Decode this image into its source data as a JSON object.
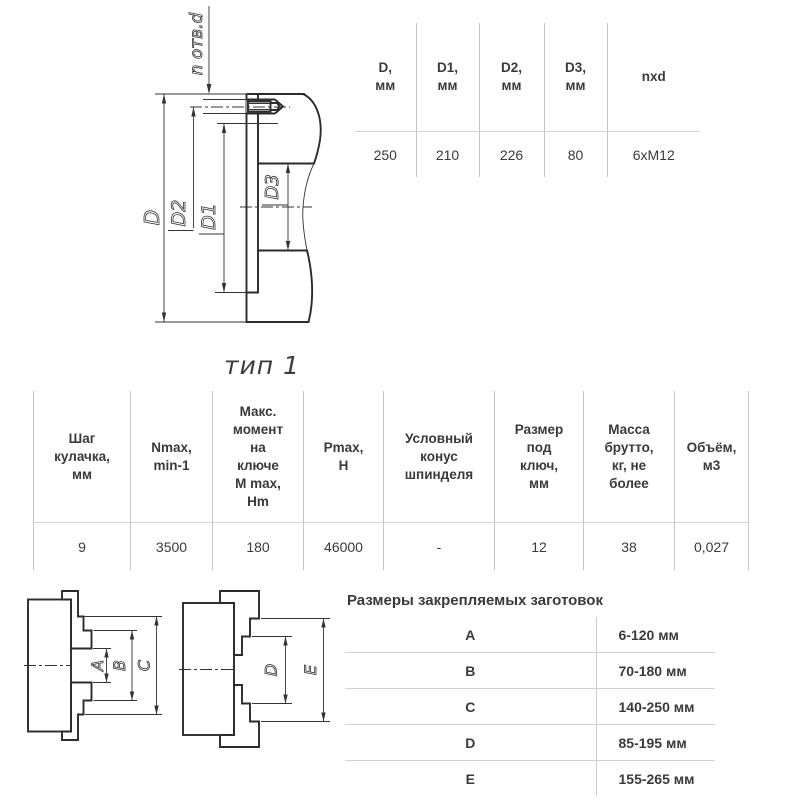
{
  "type_label": "тип 1",
  "flange_drawing": {
    "leader": "n отв.d",
    "dims": {
      "d": "D",
      "d2": "D2",
      "d1": "D1",
      "d3": "D3"
    }
  },
  "flange_table": {
    "headers": [
      [
        "D,",
        "мм"
      ],
      [
        "D1,",
        "мм"
      ],
      [
        "D2,",
        "мм"
      ],
      [
        "D3,",
        "мм"
      ],
      [
        "nxd"
      ]
    ],
    "values": [
      "250",
      "210",
      "226",
      "80",
      "6xM12"
    ]
  },
  "spec_table": {
    "headers": [
      [
        "Шаг",
        "кулачка,",
        "мм"
      ],
      [
        "Nmax,",
        "min-1"
      ],
      [
        "Макс.",
        "момент",
        "на",
        "ключе",
        "M max,",
        "Hm"
      ],
      [
        "Pmax,",
        "H"
      ],
      [
        "Условный",
        "конус",
        "шпинделя"
      ],
      [
        "Размер",
        "под",
        "ключ,",
        "мм"
      ],
      [
        "Масса",
        "брутто,",
        "кг, не",
        "более"
      ],
      [
        "Объём,",
        "м3"
      ]
    ],
    "values": [
      "9",
      "3500",
      "180",
      "46000",
      "-",
      "12",
      "38",
      "0,027"
    ]
  },
  "workpiece_table": {
    "title": "Размеры закрепляемых заготовок",
    "rows": [
      {
        "name": "A",
        "value": "6-120 мм"
      },
      {
        "name": "B",
        "value": "70-180 мм"
      },
      {
        "name": "C",
        "value": "140-250 мм"
      },
      {
        "name": "D",
        "value": "85-195 мм"
      },
      {
        "name": "E",
        "value": "155-265 мм"
      }
    ]
  },
  "chuck_drawing": {
    "dims": {
      "a": "A",
      "b": "B",
      "c": "C",
      "d": "D",
      "e": "E"
    }
  }
}
